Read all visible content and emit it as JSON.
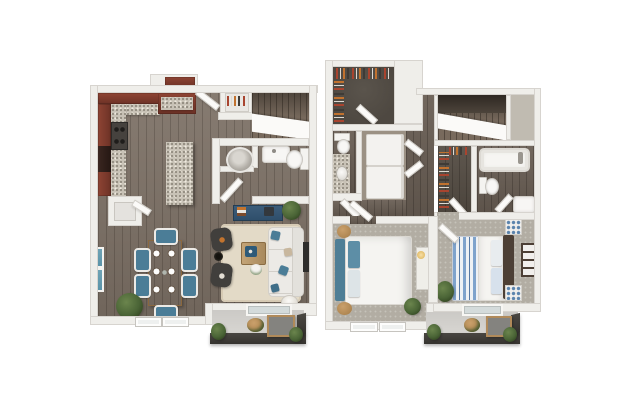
{
  "scene": {
    "type": "3d-floor-plan-rendering",
    "plans_shown": 2,
    "background": "#ffffff"
  },
  "colors": {
    "page_bg": "#ffffff",
    "wall": "#efeeea",
    "wall_edge": "#d7d4cf",
    "wood": "#7d7166",
    "wood_dark": "#6a5f55",
    "carpet": "#b2ada3",
    "carpet_light": "#c0bbb1",
    "charcoal": "#4e4841",
    "granite": "#c8c2b6",
    "granite_dot": "#8f887c",
    "cabinet_red": "#8e4434",
    "cabinet_red_dark": "#6d3226",
    "appliance": "#f3f2ef",
    "appliance_dark": "#46423e",
    "teal": "#4b7d97",
    "navy_desk": "#2f4f6b",
    "table_wood": "#b38e5e",
    "rug_cream": "#e3dac7",
    "sofa": "#eceae6",
    "sofa_shadow": "#d2cfc9",
    "chair_dark": "#413f3c",
    "bedding_white": "#f5f4f1",
    "headboard_teal": "#4e7e96",
    "headboard_wood": "#4c3f35",
    "stripe_blue": "#7fa3cc",
    "concrete": "#d8d6d2",
    "railing": "#35332f",
    "plant_green": "#4a6436",
    "plant_dark": "#2c3d1c",
    "accent_orange": "#c3742e",
    "tv_dark": "#2e2d2b",
    "glass_blue": "#5b93a8"
  },
  "floor_plans": [
    {
      "id": "first-floor",
      "rooms": [
        "kitchen",
        "dining-area",
        "living-room",
        "powder-room",
        "pantry",
        "entry-closet",
        "staircase",
        "balcony"
      ],
      "furniture": [
        "kitchen-island",
        "range-stove",
        "wall-oven",
        "dining-table",
        "dining-chairs-x6",
        "sofa",
        "accent-chairs-x2",
        "coffee-table",
        "area-rug",
        "wall-tv",
        "desk",
        "round-basin",
        "vanity-sink",
        "toilet",
        "patio-table",
        "planters"
      ]
    },
    {
      "id": "second-floor",
      "rooms": [
        "walk-in-closet-1",
        "bathroom-1",
        "laundry-closet",
        "hallway",
        "staircase",
        "walk-in-closet-2",
        "bathroom-2",
        "bedroom-1",
        "bedroom-2",
        "balcony"
      ],
      "furniture": [
        "washer-dryer",
        "bathtub",
        "toilet-x2",
        "vanity-sink-x2",
        "bed-1-teal-headboard",
        "bed-2-striped-quilt",
        "nightstands",
        "dresser",
        "console-with-lamp",
        "patio-table",
        "planters"
      ]
    }
  ]
}
